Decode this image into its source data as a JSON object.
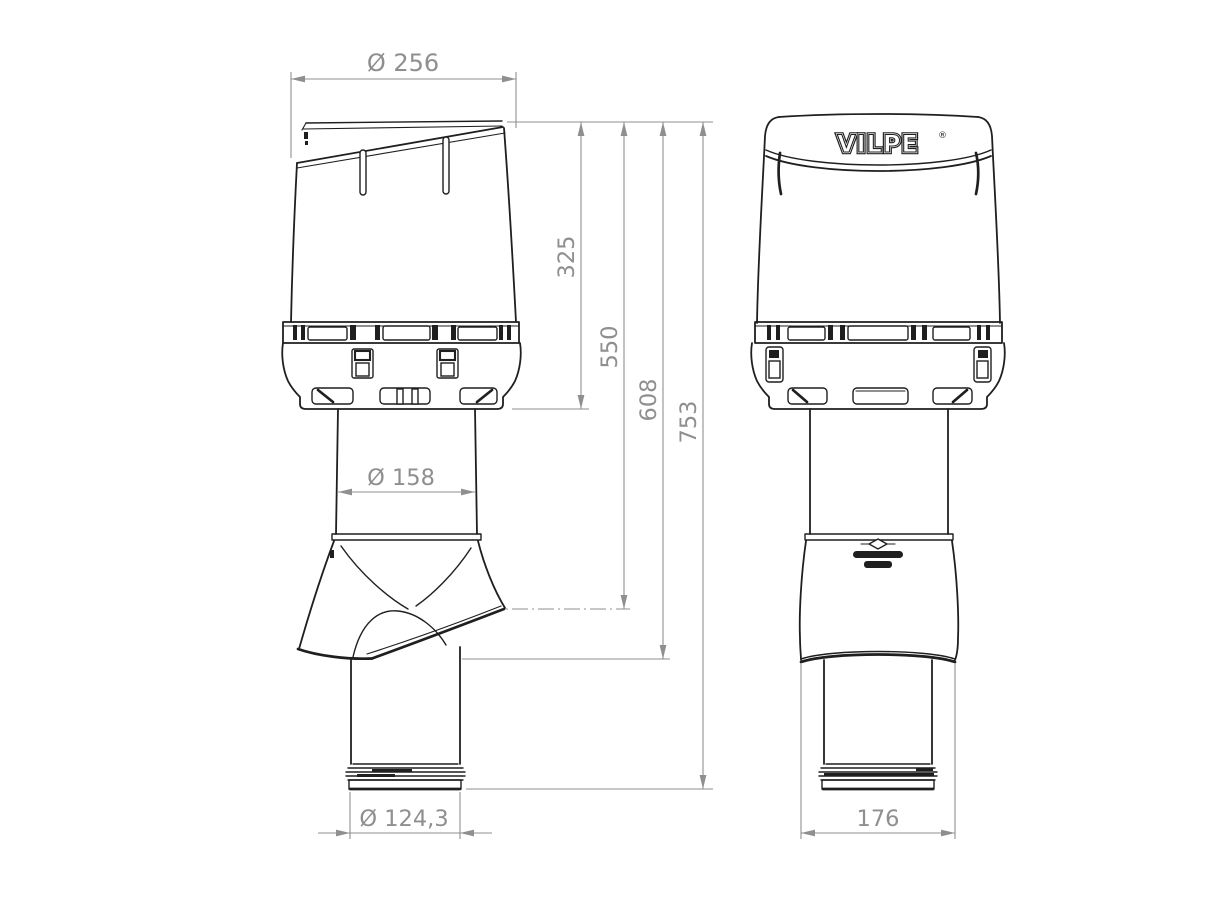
{
  "background": "#ffffff",
  "colors": {
    "outline": "#1f1f1f",
    "dimension": "#8f8f8f"
  },
  "brand": {
    "logo_text": "VILPE",
    "registered_mark": "®"
  },
  "dimensions": {
    "cap_diameter": "Ø 256",
    "cap_height": "325",
    "height_to_flashing_mid": "550",
    "height_to_flashing_bottom": "608",
    "total_height": "753",
    "upper_pipe_diameter": "Ø 158",
    "lower_pipe_diameter": "Ø 124,3",
    "flashing_width": "176"
  }
}
